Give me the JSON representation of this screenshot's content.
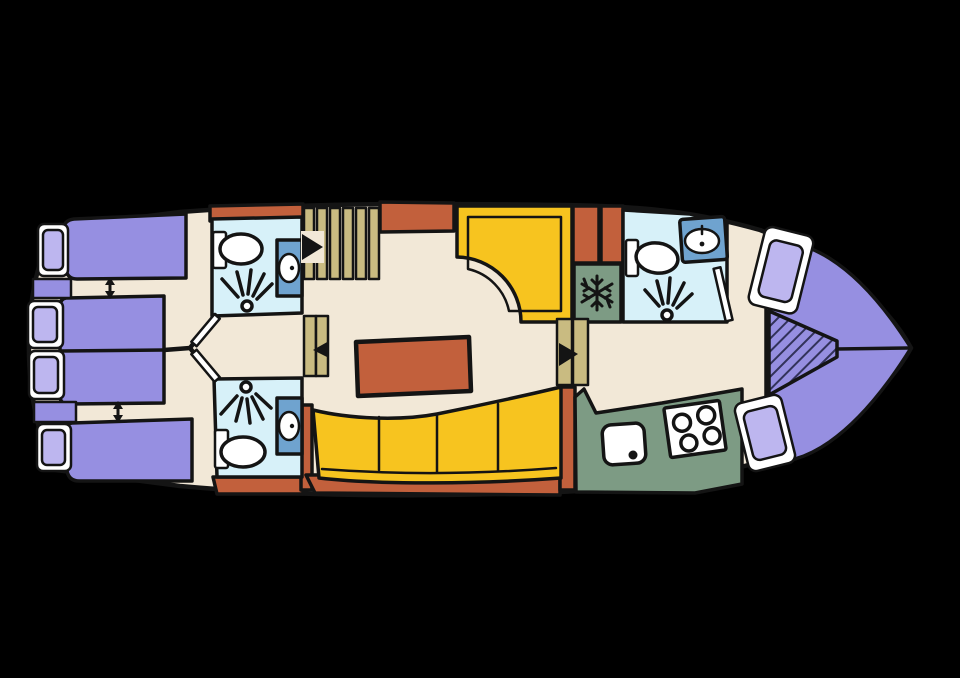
{
  "image": {
    "kind": "boat-deck-floor-plan",
    "width": 960,
    "height": 678,
    "orientation": {
      "bow": "right",
      "stern": "left"
    }
  },
  "palette": {
    "background": "#000000",
    "outline": "#141414",
    "floor": "#f2e8d7",
    "wall": "#c2603c",
    "bed": "#968fe1",
    "pillow": "#bdb6ef",
    "white": "#ffffff",
    "bathroom": "#d7f1f9",
    "cabinet": "#6fa3cf",
    "wood": "#c9bb81",
    "sofa": "#f7c41f",
    "galley": "#7d9b84",
    "hatch": "#32325a"
  },
  "areas": [
    {
      "name": "aft-cabin-upper",
      "fixtures": [
        "single-bed",
        "double-bed-half",
        "hull-window",
        "pillow",
        "bed-slide-arrow"
      ]
    },
    {
      "name": "aft-cabin-lower",
      "fixtures": [
        "single-bed",
        "double-bed-half",
        "hull-window",
        "pillow",
        "bed-slide-arrow"
      ]
    },
    {
      "name": "bathroom-aft-upper",
      "fixtures": [
        "toilet",
        "shower",
        "washbasin"
      ]
    },
    {
      "name": "bathroom-aft-lower",
      "fixtures": [
        "toilet",
        "shower",
        "washbasin"
      ]
    },
    {
      "name": "main-staircase",
      "fixtures": [
        "six-treads",
        "direction-arrow"
      ]
    },
    {
      "name": "wheelhouse",
      "fixtures": [
        "l-shaped-bench"
      ]
    },
    {
      "name": "salon",
      "fixtures": [
        "dinette-table",
        "curved-sofa-four-cushions",
        "entry-steps",
        "direction-arrow"
      ]
    },
    {
      "name": "companionway",
      "fixtures": [
        "two-treads",
        "direction-arrow"
      ]
    },
    {
      "name": "refrigerator",
      "fixtures": [
        "snowflake-symbol"
      ]
    },
    {
      "name": "bathroom-forward",
      "fixtures": [
        "toilet",
        "washbasin",
        "shower",
        "door-swing"
      ]
    },
    {
      "name": "galley",
      "fixtures": [
        "sink",
        "stove-four-burners"
      ]
    },
    {
      "name": "bow-cabin",
      "fixtures": [
        "v-berth-double-bed",
        "hatched-infill-cushion",
        "pillow",
        "pillow",
        "centerline"
      ]
    }
  ]
}
